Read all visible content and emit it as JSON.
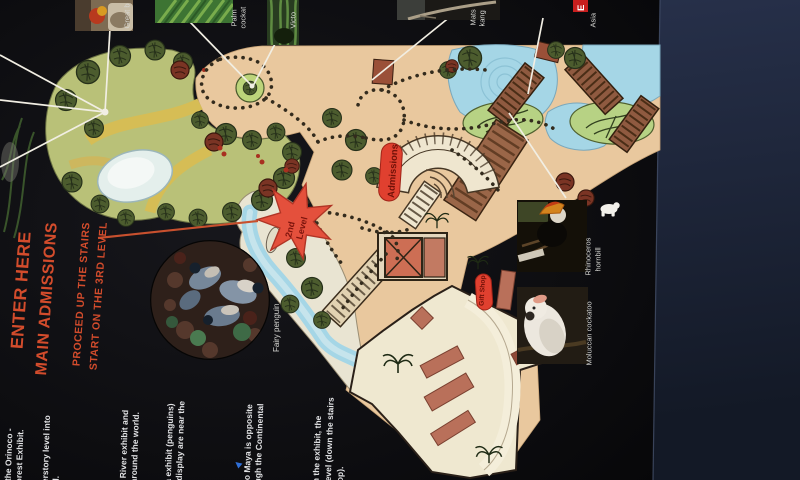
{
  "enter_block": {
    "line1": "ENTER HERE",
    "line2": "MAIN ADMISSIONS",
    "line3": "PROCEED UP THE STAIRS",
    "line4": "START ON THE 3RD LEVEL"
  },
  "map": {
    "admissions_label": "Admissions",
    "gift_shop_label": "Gift Shop",
    "level_star": {
      "line1": "2nd",
      "line2": "Level"
    }
  },
  "legend": {
    "badge": "E",
    "region_fragment": "Asia"
  },
  "photos": {
    "top": [
      {
        "id": "bird-closeup",
        "label": "Great b"
      },
      {
        "id": "palm-fronds",
        "lines": [
          "Palm",
          "cockat"
        ]
      },
      {
        "id": "rainforest-plants",
        "label": "Victo"
      },
      {
        "id": "tree-branch",
        "lines": [
          "Mats",
          "kang"
        ]
      }
    ],
    "right": [
      {
        "id": "rhinoceros-hornbill",
        "lines": [
          "Rhinoceros",
          "hornbill"
        ]
      },
      {
        "id": "moluccan-cockatoo",
        "label": "Moluccan cockatoo"
      }
    ],
    "circle": {
      "id": "fairy-penguin",
      "label": "Fairy penguin"
    }
  },
  "notes": {
    "heading_fragment": "ORED!",
    "bullet": "▲",
    "items": [
      {
        "lines": [
          "f the Orinoco -",
          "orest Exhibit."
        ]
      },
      {
        "lines": [
          "derstory level into",
          "el."
        ]
      },
      {
        "lines": [
          "e River exhibit and",
          "around the world."
        ]
      },
      {
        "lines": [
          "ca exhibit (penguins)",
          "r display are near the"
        ]
      },
      {
        "lines": [
          "do Maya is opposite",
          "ugh the Continental"
        ]
      },
      {
        "lines": [
          "gh the exhibit, the",
          "r level (down the stairs",
          "hop)."
        ]
      }
    ]
  },
  "colors": {
    "accent_orange": "#d34c2c",
    "pill_red": "#e0402f",
    "star_red": "#e4503c",
    "map_tan": "#e9c89e",
    "water_blue": "#a5d6e6",
    "forest_green": "#b9c178",
    "note_text": "#e6e6e8",
    "table_navy": "#1d2433",
    "brochure_black": "#0c0c10",
    "bullet_blue": "#2f6fd8"
  }
}
